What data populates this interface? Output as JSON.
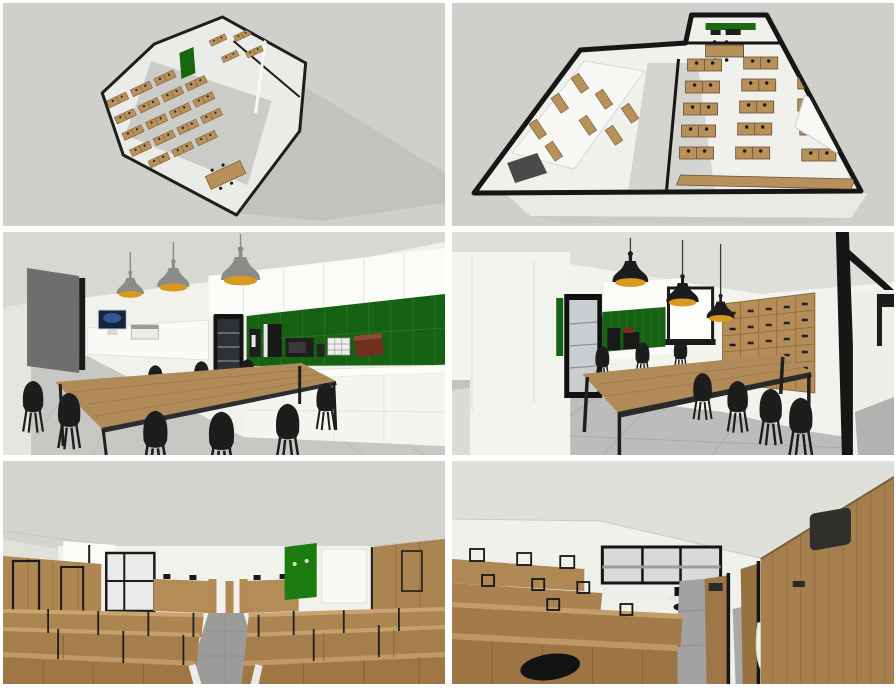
{
  "collage": {
    "title": "Office interior 3D render collage (6 views)",
    "grid": {
      "rows": 3,
      "cols": 2,
      "gap_px": 6,
      "frame_color": "#ffffff"
    },
    "panels": [
      {
        "id": "aerial-far",
        "label": "Aerial dollhouse floor plan - far view",
        "elements": [
          "black perimeter walls",
          "rows of wooden desk clusters",
          "green acoustic board",
          "meeting table",
          "cast shadow on gray ground"
        ]
      },
      {
        "id": "aerial-near",
        "label": "Aerial dollhouse floor plan - close view",
        "elements": [
          "thick black perimeter walls",
          "wooden desk grid with black chairs",
          "white partition rooms",
          "kitchen with green backsplash",
          "white base platform"
        ]
      },
      {
        "id": "kitchen-a",
        "label": "Break room kitchen - view toward counter",
        "elements": [
          "3 gray pendant lamps with amber interior",
          "white cabinets",
          "green tile backsplash",
          "glass-door fridge",
          "coffee machine",
          "microwave",
          "tea box",
          "wooden dining table",
          "black chairs",
          "iMac workstation",
          "dark gray sliding door"
        ]
      },
      {
        "id": "kitchen-b",
        "label": "Break room kitchen - view toward lockers",
        "elements": [
          "3 black pendant lamps with amber interior",
          "glass-door fridge",
          "green tile backsplash",
          "white board",
          "wooden locker wall with black handles",
          "wooden dining table",
          "black chairs",
          "black framed glass partition"
        ]
      },
      {
        "id": "openspace-aisle",
        "label": "Open space - central aisle between wooden cubicles",
        "elements": [
          "rows of wooden desk partitions",
          "central gray walkway",
          "green acoustic board",
          "black framed window",
          "white walls"
        ]
      },
      {
        "id": "openspace-close",
        "label": "Open space - close-up of wooden cubicle walls",
        "elements": [
          "tall wooden partition walls",
          "dark storage cubby",
          "black framed window",
          "white task chair",
          "black chair",
          "gray walkway"
        ]
      }
    ],
    "palette": {
      "background_gray": "#cfcfcb",
      "ceiling_gray": "#d8d8d3",
      "wall_white": "#f2f2ed",
      "wood": "#b08a58",
      "wood_dark": "#9c7544",
      "wood_light": "#c6a26d",
      "green_tile": "#166112",
      "green_board": "#1d7c10",
      "lamp_amber": "#d89a1e",
      "frame_black": "#161616",
      "floor_gray": "#c7c7c4",
      "aisle_gray": "#9b9b99",
      "shadow_gray": "#c2c2bf",
      "box_brown": "#71301f",
      "door_gray": "#6e6e6e"
    }
  }
}
